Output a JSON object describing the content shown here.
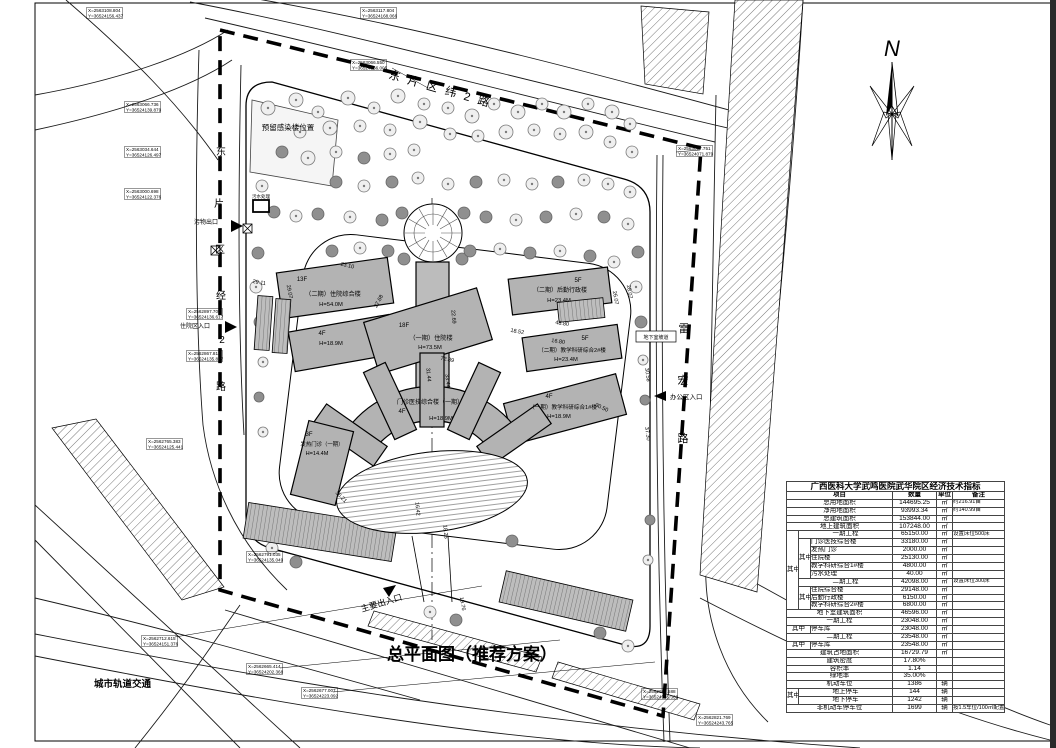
{
  "title": "总平面图（推荐方案）",
  "north_label": "N",
  "roads": {
    "top": "东片区纬2路",
    "left": "东片区经2路",
    "right": "雷宏路",
    "metro": "城市轨道交通"
  },
  "labels": {
    "reserved": "预留感染楼位置",
    "sewage": "污水处理",
    "ramp": "地下室坡道",
    "main_entrance": "主要出入口",
    "office_entrance": "办公区入口",
    "inpatient_entrance": "住院区入口",
    "waste_exit": "污物出口"
  },
  "buildings": [
    {
      "floors": "13F",
      "name": "（二期）住院综合楼",
      "height": "H=54.0M"
    },
    {
      "floors": "4F",
      "name": "",
      "height": "H=18.9M"
    },
    {
      "floors": "18F",
      "name": "（一期）住院楼",
      "height": "H=73.5M"
    },
    {
      "floors": "5F",
      "name": "（二期）后勤行政楼",
      "height": "H=23.4M"
    },
    {
      "floors": "5F",
      "name": "（二期）教学科研综合2#楼",
      "height": "H=23.4M"
    },
    {
      "floors": "4F",
      "name": "（一期）教学科研综合1#楼",
      "height": "H=18.9M"
    },
    {
      "floors": "4F",
      "name": "门诊医技综合楼（一期）",
      "height": "H=18.9M"
    },
    {
      "floors": "3F",
      "name": "发热门诊（一期）",
      "height": "H=14.4M"
    }
  ],
  "dimensions": [
    "23.10",
    "29.07",
    "27.68",
    "22.69",
    "72.89",
    "31.44",
    "33.44",
    "18.52",
    "48.80",
    "16.80",
    "26.07",
    "30.58",
    "37.30",
    "30.50",
    "16.42",
    "18.26",
    "29.11",
    "19.76",
    "36.21",
    "28.07"
  ],
  "coordinates": [
    {
      "x": "X=2563108.804",
      "y": "Y=36524156.437"
    },
    {
      "x": "X=2563117.804",
      "y": "Y=36524168.066"
    },
    {
      "x": "X=2563066.550",
      "y": "Y=36524166.005"
    },
    {
      "x": "X=2563066.736",
      "y": "Y=36524139.879"
    },
    {
      "x": "X=2563034.644",
      "y": "Y=36524126.497"
    },
    {
      "x": "X=2563000.698",
      "y": "Y=36524122.376"
    },
    {
      "x": "X=2563017.751",
      "y": "Y=36524071.879"
    },
    {
      "x": "X=2562897.709",
      "y": "Y=36524136.617"
    },
    {
      "x": "X=2562867.812",
      "y": "Y=36524135.817"
    },
    {
      "x": "X=2562765.383",
      "y": "Y=36524125.441"
    },
    {
      "x": "X=2562791.035",
      "y": "Y=36524135.049"
    },
    {
      "x": "X=2562712.615",
      "y": "Y=36524151.376"
    },
    {
      "x": "X=2562665.414",
      "y": "Y=36524202.368"
    },
    {
      "x": "X=2562677.007",
      "y": "Y=36524223.092"
    },
    {
      "x": "X=2562683.588",
      "y": "Y=36524185.368"
    },
    {
      "x": "X=2562821.769",
      "y": "Y=36524243.765"
    }
  ],
  "table": {
    "title": "广西医科大学武鸣医院武华院区经济技术指标",
    "header": [
      {
        "t": "项目",
        "cs": 3,
        "c": "hdr"
      },
      {
        "t": "数量",
        "c": "hdr"
      },
      {
        "t": "单位",
        "c": "hdr"
      },
      {
        "t": "备注",
        "c": "hdr"
      }
    ],
    "rows": [
      [
        {
          "t": "总用地面积",
          "cs": 3,
          "c": "lbl"
        },
        {
          "t": "144695.25",
          "c": "val"
        },
        {
          "t": "㎡",
          "c": "unit"
        },
        {
          "t": "约216.91亩",
          "c": "note"
        }
      ],
      [
        {
          "t": "净用地面积",
          "cs": 3,
          "c": "lbl"
        },
        {
          "t": "93993.34",
          "c": "val"
        },
        {
          "t": "㎡",
          "c": "unit"
        },
        {
          "t": "约140.99亩",
          "c": "note"
        }
      ],
      [
        {
          "t": "总建筑面积",
          "cs": 3,
          "c": "lbl"
        },
        {
          "t": "153844.00",
          "c": "val"
        },
        {
          "t": "㎡",
          "c": "unit"
        },
        {
          "t": "",
          "c": "note"
        }
      ],
      [
        {
          "t": "地上建筑面积",
          "cs": 3,
          "c": "lbl"
        },
        {
          "t": "107248.00",
          "c": "val"
        },
        {
          "t": "㎡",
          "c": "unit"
        },
        {
          "t": "",
          "c": "note"
        }
      ],
      [
        {
          "t": "其中",
          "rs": 10,
          "c": "grp"
        },
        {
          "t": "一期工程",
          "cs": 2,
          "c": "lbl"
        },
        {
          "t": "65150.00",
          "c": "val"
        },
        {
          "t": "㎡",
          "c": "unit"
        },
        {
          "t": "设置床位500床",
          "c": "note"
        }
      ],
      [
        {
          "t": "其中",
          "rs": 5,
          "c": "grp"
        },
        {
          "t": "门诊医技综合楼",
          "c": "lblL"
        },
        {
          "t": "33180.00",
          "c": "val"
        },
        {
          "t": "㎡",
          "c": "unit"
        },
        {
          "t": "",
          "c": "note"
        }
      ],
      [
        {
          "t": "发热门诊",
          "c": "lblL"
        },
        {
          "t": "2000.00",
          "c": "val"
        },
        {
          "t": "㎡",
          "c": "unit"
        },
        {
          "t": "",
          "c": "note"
        }
      ],
      [
        {
          "t": "住院楼",
          "c": "lblL"
        },
        {
          "t": "25130.00",
          "c": "val"
        },
        {
          "t": "㎡",
          "c": "unit"
        },
        {
          "t": "",
          "c": "note"
        }
      ],
      [
        {
          "t": "教学科研综合1#楼",
          "c": "lblL"
        },
        {
          "t": "4800.00",
          "c": "val"
        },
        {
          "t": "㎡",
          "c": "unit"
        },
        {
          "t": "",
          "c": "note"
        }
      ],
      [
        {
          "t": "污水处理",
          "c": "lblL"
        },
        {
          "t": "40.00",
          "c": "val"
        },
        {
          "t": "㎡",
          "c": "unit"
        },
        {
          "t": "",
          "c": "note"
        }
      ],
      [
        {
          "t": "二期工程",
          "cs": 2,
          "c": "lbl"
        },
        {
          "t": "42098.00",
          "c": "val"
        },
        {
          "t": "㎡",
          "c": "unit"
        },
        {
          "t": "设置床位300床",
          "c": "note"
        }
      ],
      [
        {
          "t": "其中",
          "rs": 3,
          "c": "grp"
        },
        {
          "t": "住院综合楼",
          "c": "lblL"
        },
        {
          "t": "29148.00",
          "c": "val"
        },
        {
          "t": "㎡",
          "c": "unit"
        },
        {
          "t": "",
          "c": "note"
        }
      ],
      [
        {
          "t": "后勤行政楼",
          "c": "lblL"
        },
        {
          "t": "6150.00",
          "c": "val"
        },
        {
          "t": "㎡",
          "c": "unit"
        },
        {
          "t": "",
          "c": "note"
        }
      ],
      [
        {
          "t": "教学科研综合2#楼",
          "c": "lblL"
        },
        {
          "t": "6800.00",
          "c": "val"
        },
        {
          "t": "㎡",
          "c": "unit"
        },
        {
          "t": "",
          "c": "note"
        }
      ],
      [
        {
          "t": "地下室建筑面积",
          "cs": 3,
          "c": "lbl"
        },
        {
          "t": "46596.00",
          "c": "val"
        },
        {
          "t": "㎡",
          "c": "unit"
        },
        {
          "t": "",
          "c": "note"
        }
      ],
      [
        {
          "t": "一期工程",
          "cs": 3,
          "c": "lbl"
        },
        {
          "t": "23048.00",
          "c": "val"
        },
        {
          "t": "㎡",
          "c": "unit"
        },
        {
          "t": "",
          "c": "note"
        }
      ],
      [
        {
          "t": "其中",
          "cs": 2,
          "c": "grp"
        },
        {
          "t": "停车库",
          "c": "lblL"
        },
        {
          "t": "23048.00",
          "c": "val"
        },
        {
          "t": "㎡",
          "c": "unit"
        },
        {
          "t": "",
          "c": "note"
        }
      ],
      [
        {
          "t": "二期工程",
          "cs": 3,
          "c": "lbl"
        },
        {
          "t": "23548.00",
          "c": "val"
        },
        {
          "t": "㎡",
          "c": "unit"
        },
        {
          "t": "",
          "c": "note"
        }
      ],
      [
        {
          "t": "其中",
          "cs": 2,
          "c": "grp"
        },
        {
          "t": "停车库",
          "c": "lblL"
        },
        {
          "t": "23548.00",
          "c": "val"
        },
        {
          "t": "㎡",
          "c": "unit"
        },
        {
          "t": "",
          "c": "note"
        }
      ],
      [
        {
          "t": "建筑占地面积",
          "cs": 3,
          "c": "lbl"
        },
        {
          "t": "16729.79",
          "c": "val"
        },
        {
          "t": "㎡",
          "c": "unit"
        },
        {
          "t": "",
          "c": "note"
        }
      ],
      [
        {
          "t": "建筑密度",
          "cs": 3,
          "c": "lbl"
        },
        {
          "t": "17.80%",
          "c": "val"
        },
        {
          "t": "",
          "c": "unit"
        },
        {
          "t": "",
          "c": "note"
        }
      ],
      [
        {
          "t": "容积率",
          "cs": 3,
          "c": "lbl"
        },
        {
          "t": "1.14",
          "c": "val"
        },
        {
          "t": "",
          "c": "unit"
        },
        {
          "t": "",
          "c": "note"
        }
      ],
      [
        {
          "t": "绿地率",
          "cs": 3,
          "c": "lbl"
        },
        {
          "t": "35.00%",
          "c": "val"
        },
        {
          "t": "",
          "c": "unit"
        },
        {
          "t": "",
          "c": "note"
        }
      ],
      [
        {
          "t": "机动车位",
          "cs": 3,
          "c": "lbl"
        },
        {
          "t": "1386",
          "c": "val"
        },
        {
          "t": "辆",
          "c": "unit"
        },
        {
          "t": "",
          "c": "note"
        }
      ],
      [
        {
          "t": "其中",
          "rs": 2,
          "c": "grp"
        },
        {
          "t": "地上停车",
          "cs": 2,
          "c": "lbl"
        },
        {
          "t": "144",
          "c": "val"
        },
        {
          "t": "辆",
          "c": "unit"
        },
        {
          "t": "",
          "c": "note"
        }
      ],
      [
        {
          "t": "地下停车",
          "cs": 2,
          "c": "lbl"
        },
        {
          "t": "1242",
          "c": "val"
        },
        {
          "t": "辆",
          "c": "unit"
        },
        {
          "t": "",
          "c": "note"
        }
      ],
      [
        {
          "t": "非机动车停车位",
          "cs": 3,
          "c": "lbl"
        },
        {
          "t": "1699",
          "c": "val"
        },
        {
          "t": "辆",
          "c": "unit"
        },
        {
          "t": "按1.5车位/100㎡配置",
          "c": "note"
        }
      ]
    ]
  }
}
